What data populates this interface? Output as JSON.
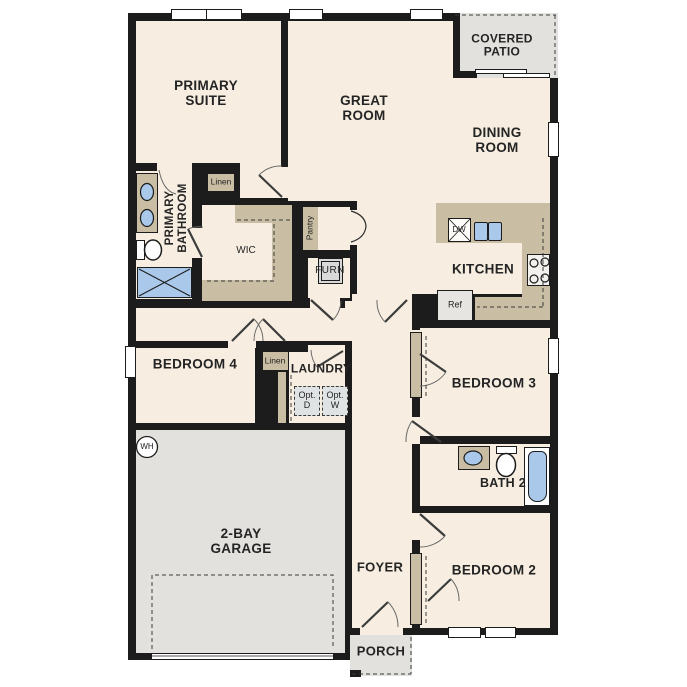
{
  "plan_title": "single-story floor plan",
  "rooms": {
    "primary_suite": "PRIMARY SUITE",
    "great_room": "GREAT ROOM",
    "dining_room": "DINING ROOM",
    "covered_patio": "COVERED PATIO",
    "kitchen": "KITCHEN",
    "primary_bathroom": "PRIMARY BATHROOM",
    "wic": "WIC",
    "bedroom4": "BEDROOM 4",
    "laundry": "LAUNDRY",
    "garage": "2-BAY GARAGE",
    "foyer": "FOYER",
    "porch": "PORCH",
    "bedroom3": "BEDROOM 3",
    "bath2": "BATH 2",
    "bedroom2": "BEDROOM 2"
  },
  "closets": {
    "linen_top": "Linen",
    "linen_mid": "Linen",
    "pantry": "Pantry"
  },
  "equipment": {
    "furnace": "FURN",
    "fridge": "Ref",
    "dishwasher": "DW",
    "water_heater": "WH",
    "opt_dryer": "Opt. D",
    "opt_washer": "Opt. W"
  },
  "colors": {
    "floor_cream": "#f7eee1",
    "wall_black": "#1c1c1c",
    "cabinet_tan": "#c9bda4",
    "garage_gray": "#e2e1de",
    "fixture_blue": "#aac9ea",
    "appliance_gray": "#e0e3e4"
  }
}
